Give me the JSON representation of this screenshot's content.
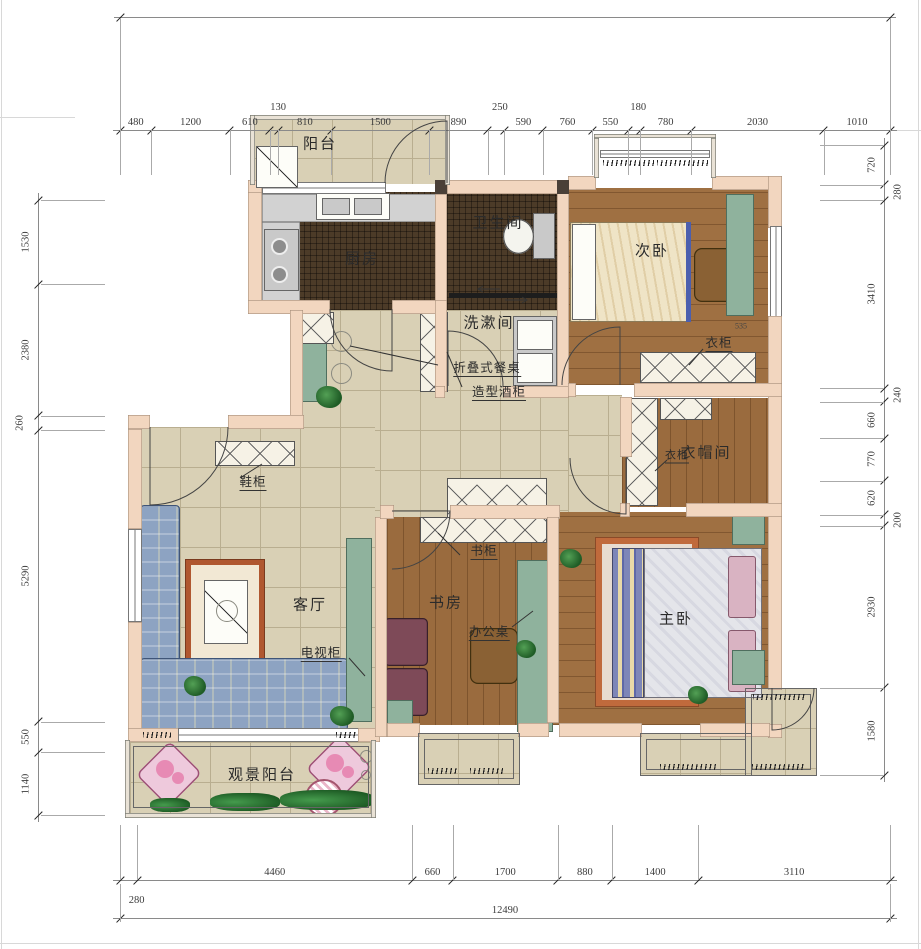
{
  "rooms": {
    "balcony": "阳台",
    "kitchen": "厨房",
    "bathroom": "卫生间",
    "washroom": "洗漱间",
    "bedroom2": "次卧",
    "cloakroom": "衣帽间",
    "living": "客厅",
    "study": "书房",
    "master": "主卧",
    "view_balcony": "观景阳台"
  },
  "annotations": {
    "folding_table": "折叠式餐桌",
    "wine_cabinet": "造型酒柜",
    "shoe_cabinet": "鞋柜",
    "tv_cabinet": "电视柜",
    "bookcase": "书柜",
    "office_desk": "办公桌",
    "wardrobe_bedroom2": "衣柜",
    "wardrobe_cloakroom": "衣柜",
    "wardrobe_size": "535"
  },
  "dimensions": {
    "top": [
      480,
      1200,
      610,
      130,
      810,
      1500,
      890,
      250,
      590,
      760,
      550,
      180,
      780,
      2030,
      1010
    ],
    "bottom": [
      280,
      4460,
      660,
      1700,
      880,
      1400,
      3110
    ],
    "total": [
      12490
    ],
    "left": [
      1530,
      2380,
      260,
      5290,
      550,
      1140
    ],
    "right": [
      720,
      280,
      3410,
      240,
      660,
      770,
      620,
      200,
      2930,
      1580
    ]
  },
  "colors": {
    "wall": "#f2d6bf",
    "tile_floor": "#d9d0b5",
    "dark_floor": "#4c3b28",
    "wood_floor": "#9a6b3e",
    "furniture_green": "#8fb29d",
    "rug_accent": "#b0572f"
  }
}
